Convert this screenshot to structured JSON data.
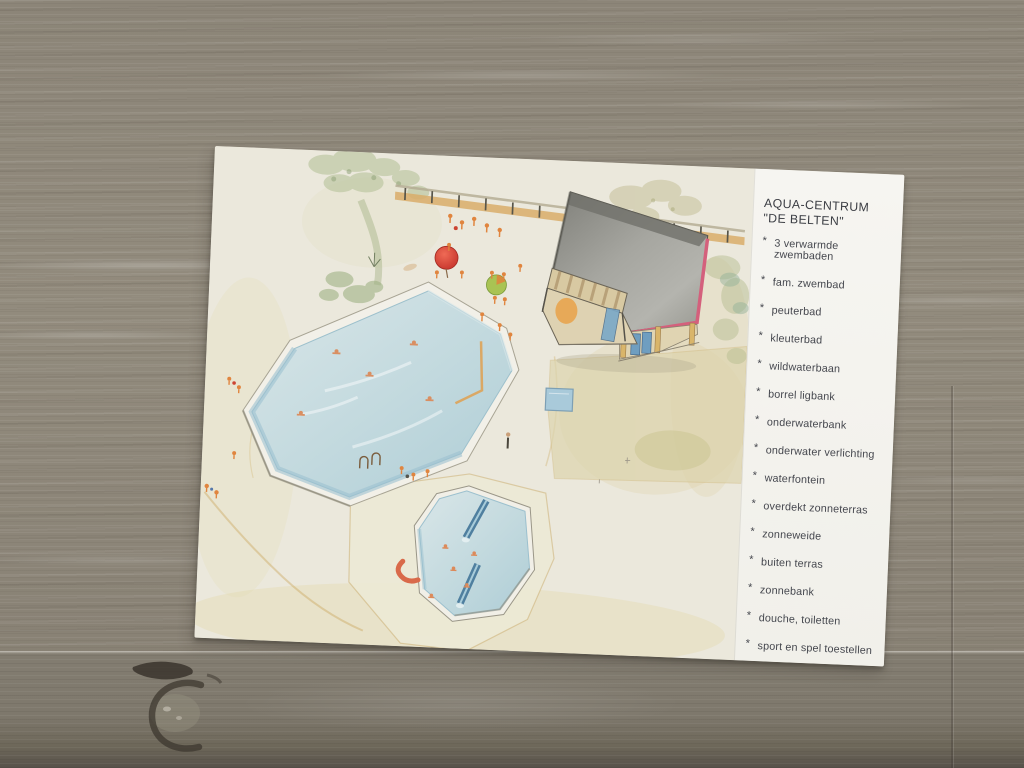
{
  "photo": {
    "subject": "postcard of a holiday-park aqua centre lying on a whitewashed wooden table",
    "postcard": {
      "panel": {
        "title_line1": "AQUA-CENTRUM",
        "title_line2": "\"DE BELTEN\"",
        "bullet": "*",
        "items": [
          "3 verwarmde zwembaden",
          "fam. zwembad",
          "peuterbad",
          "kleuterbad",
          "wildwaterbaan",
          "borrel ligbank",
          "onderwaterbank",
          "onderwater verlichting",
          "waterfontein",
          "overdekt zonneterras",
          "zonneweide",
          "buiten terras",
          "zonnebank",
          "douche, toiletten",
          "sport en spel toestellen"
        ]
      },
      "illustration": {
        "caption": "aerial colored-pencil drawing of the aqua centre grounds",
        "features": [
          "large octagonal family pool with swimmers",
          "children's pool with two blue slides",
          "red curved slide on the deck",
          "entrance building with grey roof and red trim",
          "kiosk with striped awning and blue door",
          "fence with small figures along the top terrace",
          "red parasol",
          "green parasol",
          "sandy sunbathing area",
          "small square fountain pond",
          "trees and shrubs"
        ]
      }
    },
    "colors": {
      "table_wood": "#8f8879",
      "table_wood_dark": "#6d6457",
      "card_paper": "#ebe8dc",
      "panel_paper": "#f4f3ef",
      "text": "#45474e",
      "pool_water": "#c3d9de",
      "roof_grey": "#9a9a94",
      "roof_trim_red": "#d4607c",
      "slide_blue": "#4f7f9f",
      "accent_orange": "#e0853f",
      "foliage_green": "#b6c29a",
      "sand": "#ddd5ae"
    }
  }
}
